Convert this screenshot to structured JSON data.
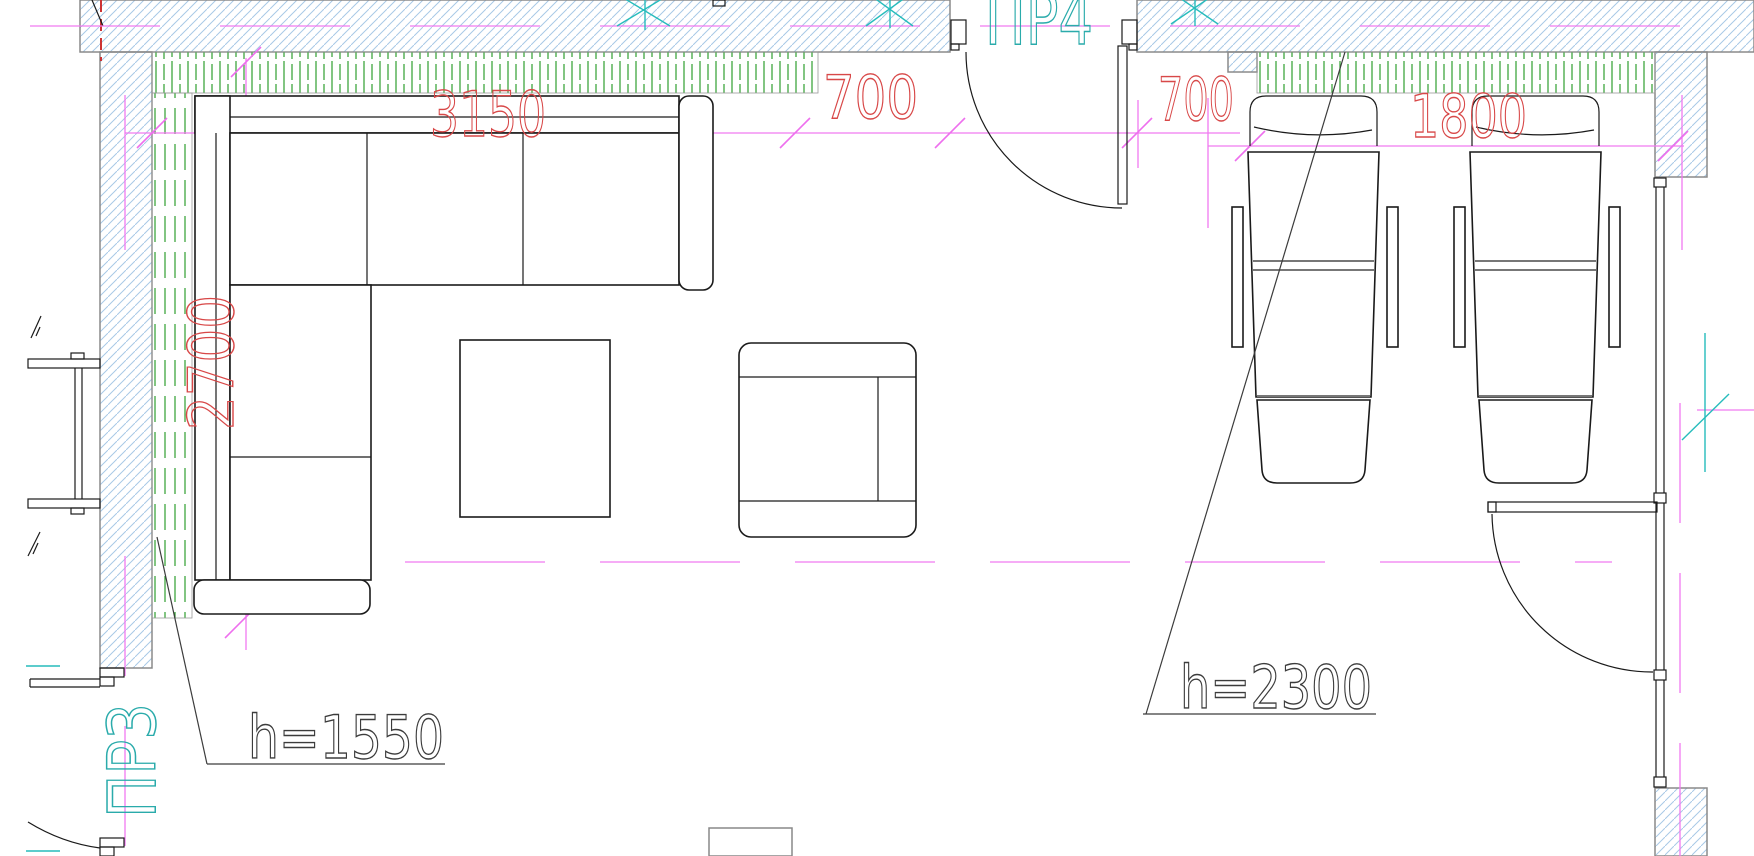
{
  "dimensions": {
    "sofa_width": "3150",
    "gap_left": "700",
    "gap_right": "700",
    "chairs_width": "1800",
    "sofa_depth": "2700"
  },
  "heights": {
    "sofa_zone": "h=1550",
    "chairs_zone": "h=2300"
  },
  "openings": {
    "door_top": "ПР4",
    "door_bottom_left": "ПР3"
  },
  "colors": {
    "dimension_text": "#d84848",
    "axis_magenta": "#f07af0",
    "marker_cyan": "#26bcbc",
    "wall_hatch_blue": "#a8c9e6",
    "insulation_green": "#2e9e2e",
    "furniture_outline": "#1a1a1a",
    "wall_outline": "#8a8a8a"
  }
}
